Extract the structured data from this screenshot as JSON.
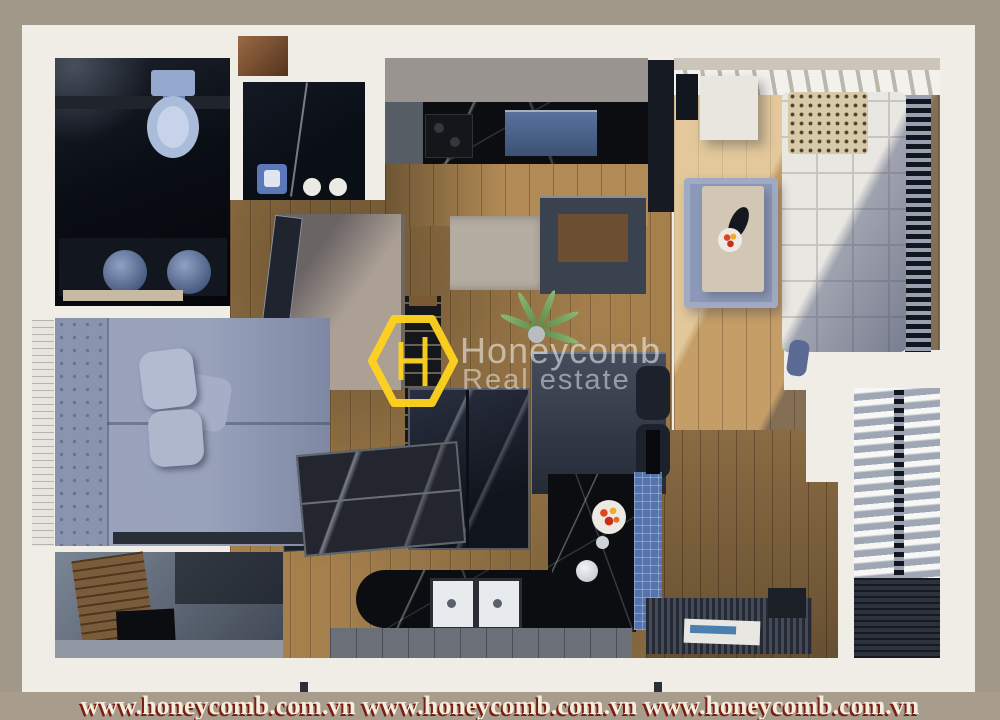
{
  "scene": {
    "description": "Top-down 3D render of a furnished one/two-bedroom apartment floor plan: dark bathrooms with toilet and twin basins, kitchen with black marble counters, blue upholstered bed, white quilted sofa, blue rug with coffee table and fruit bowl, glass dining table, black island with fruit plate and double sink, balcony with white wavy curtains"
  },
  "watermark": {
    "brand": "Honeycomb",
    "tagline": "Real estate",
    "logo_letter": "H",
    "logo_color": "#FFD21E",
    "text_color": "rgba(255,255,255,0.52)"
  },
  "footer": {
    "urls": [
      "www.honeycomb.com.vn",
      "www.honeycomb.com.vn",
      "www.honeycomb.com.vn"
    ],
    "text": "www.honeycomb.com.vn www.honeycomb.com.vn www.honeycomb.com.vn",
    "background_color": "#A89D8C",
    "text_color": "#F4ECDC",
    "shadow_color": "#7A1C10"
  },
  "palette": {
    "page_background": "#A2988A",
    "wall_white": "#F0EDE6",
    "dark_room": "#0B0E15",
    "wood_floor": "#A5804D",
    "sofa_white": "#E9E7E2",
    "bed_blue": "#99A2BB",
    "rug_blue": "#8B98B8",
    "marble_black": "#0B0D11",
    "tile_blue": "#5574AE",
    "accent_yellow": "#FFD21E",
    "fruit_red": "#CC2E1A"
  }
}
